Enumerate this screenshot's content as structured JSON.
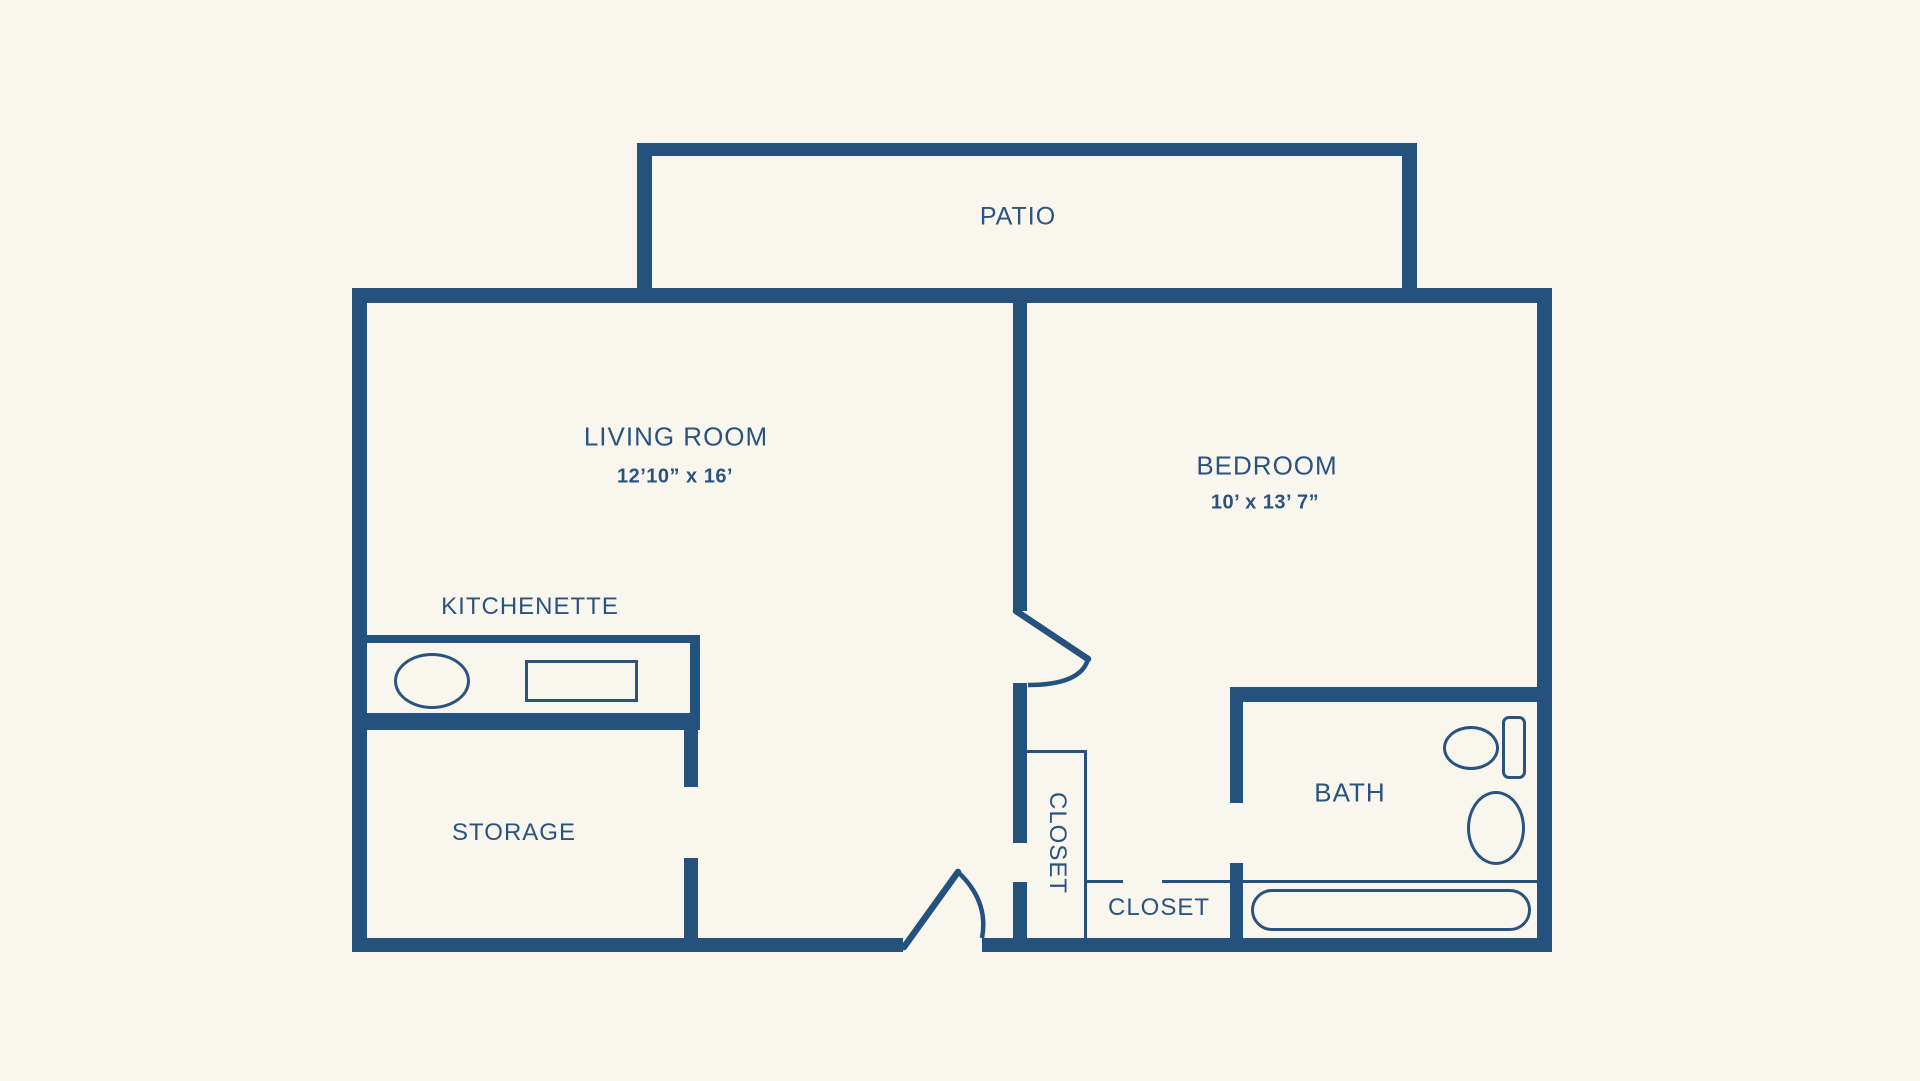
{
  "plan": {
    "title": "one-bedroom floor plan",
    "colors": {
      "background": "#f9f6ee",
      "wall": "#25517e",
      "text": "#2a547f"
    },
    "rooms": {
      "patio": {
        "label": "PATIO"
      },
      "living_room": {
        "label": "LIVING ROOM",
        "dims": "12’10” x 16’"
      },
      "bedroom": {
        "label": "BEDROOM",
        "dims": "10’ x 13’ 7”"
      },
      "kitchenette": {
        "label": "KITCHENETTE"
      },
      "storage": {
        "label": "STORAGE"
      },
      "closet_hall": {
        "label": "CLOSET"
      },
      "closet_bedroom": {
        "label": "CLOSET"
      },
      "bath": {
        "label": "BATH"
      }
    },
    "fixtures": [
      "kitchen-sink",
      "stove",
      "toilet",
      "bath-sink",
      "bathtub"
    ]
  }
}
